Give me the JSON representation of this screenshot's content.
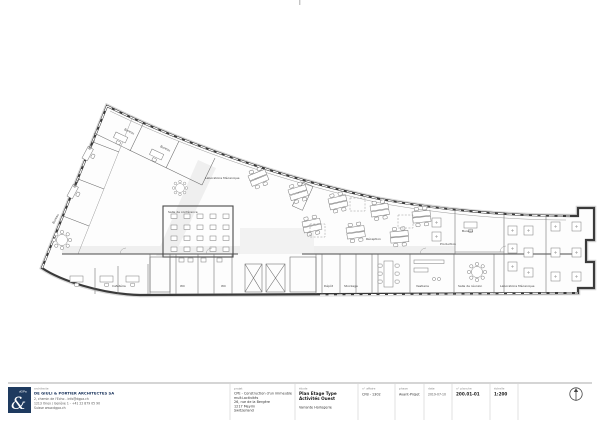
{
  "colors": {
    "logo_navy": "#1e3a5f",
    "wall_dark": "#3a3a3a",
    "corridor_gray": "#efefef"
  },
  "plan": {
    "labels": [
      {
        "text": "Bureau",
        "x": 90,
        "y": 150,
        "r": -62
      },
      {
        "text": "Bureau",
        "x": 75,
        "y": 188,
        "r": -62
      },
      {
        "text": "Bureau",
        "x": 54,
        "y": 224,
        "r": -62
      },
      {
        "text": "Bureau",
        "x": 124,
        "y": 130,
        "r": 25
      },
      {
        "text": "Bureau",
        "x": 160,
        "y": 147,
        "r": 25
      },
      {
        "text": "Laboratoire Mécanique",
        "x": 205,
        "y": 179,
        "r": 0
      },
      {
        "text": "Salle de conférence",
        "x": 168,
        "y": 213,
        "r": 0
      },
      {
        "text": "Cafétéria",
        "x": 112,
        "y": 287,
        "r": 0
      },
      {
        "text": "WC",
        "x": 180,
        "y": 287,
        "r": 0
      },
      {
        "text": "WC",
        "x": 221,
        "y": 287,
        "r": 0
      },
      {
        "text": "Réception",
        "x": 366,
        "y": 240,
        "r": 0
      },
      {
        "text": "Dépôt",
        "x": 324,
        "y": 287,
        "r": 0
      },
      {
        "text": "Stockage",
        "x": 344,
        "y": 287,
        "r": 0
      },
      {
        "text": "Vestiaire",
        "x": 416,
        "y": 287,
        "r": 0
      },
      {
        "text": "Salle de réunion",
        "x": 458,
        "y": 287,
        "r": 0
      },
      {
        "text": "Laboratoire Mécanique",
        "x": 500,
        "y": 287,
        "r": 0
      },
      {
        "text": "Production",
        "x": 440,
        "y": 245,
        "r": 0
      },
      {
        "text": "Bureau",
        "x": 462,
        "y": 232,
        "r": 0
      }
    ]
  },
  "title_block": {
    "architect": {
      "role_label": "architecte",
      "name": "DE GIULI & PORTIER ARCHITECTES SA",
      "address_line1": "2, chemin de l'Echo - info@dgpa.ch",
      "address_line2": "1213 Onex / Genève 1 - +41 22 879 05 90",
      "address_line3": "Suisse www.dgpa.ch",
      "logo_text": "dGPa",
      "logo_glyph": "&"
    },
    "project": {
      "label": "projet",
      "line1": "CPE - Construction d'un immeuble",
      "line2": "multi-activités",
      "line3": "26, rue de la Bergère",
      "line4": "1217 Meyrin",
      "line5": "Switzerland"
    },
    "study": {
      "label": "étude",
      "line1": "Plan Etage Type",
      "line2": "Activités Ouest",
      "variant": "Variante Horlogerie"
    },
    "fields": [
      {
        "label": "n° affaire",
        "value": "CFB - 1302"
      },
      {
        "label": "phase",
        "value": "Avant-Projet"
      },
      {
        "label": "date",
        "value": "2019-07-10"
      },
      {
        "label": "n° planche",
        "value": "200.01-01"
      },
      {
        "label": "échelle",
        "value": "1:200"
      }
    ]
  }
}
